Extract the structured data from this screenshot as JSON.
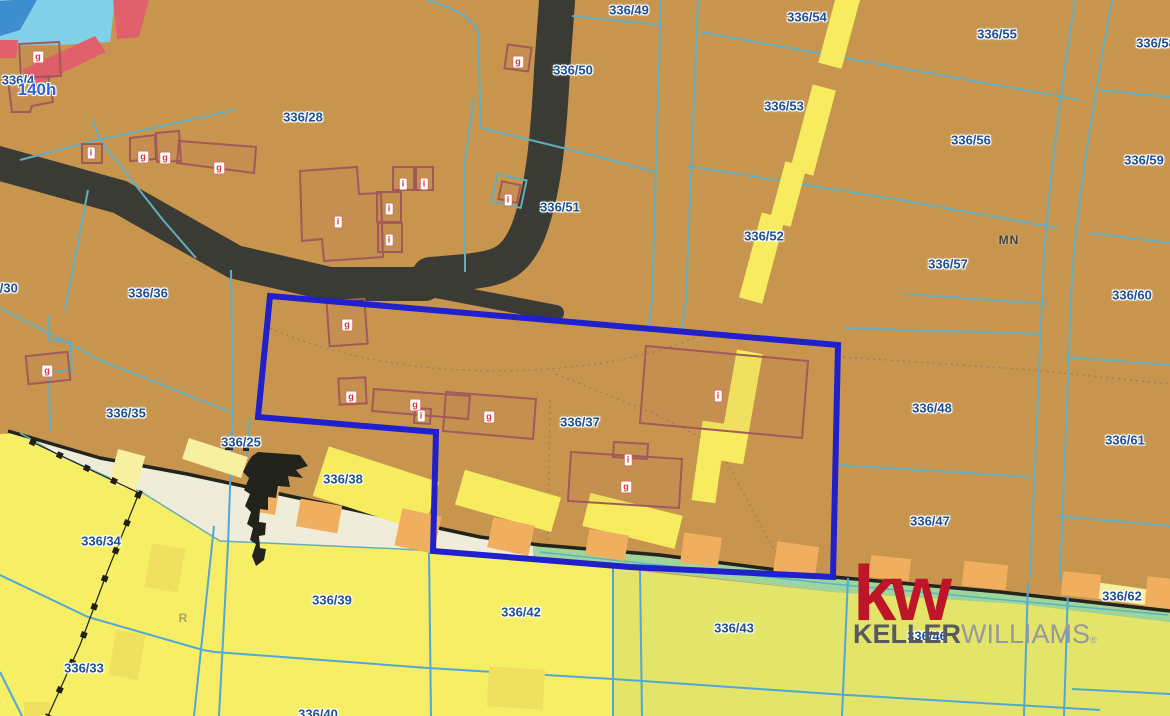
{
  "map": {
    "labels": [
      {
        "text": "336/4",
        "x": 18,
        "y": 80,
        "kind": "parcel"
      },
      {
        "text": "140h",
        "x": 37,
        "y": 90,
        "kind": "hectare"
      },
      {
        "text": "336/28",
        "x": 303,
        "y": 117,
        "kind": "parcel"
      },
      {
        "text": "336/49",
        "x": 629,
        "y": 10,
        "kind": "parcel"
      },
      {
        "text": "336/50",
        "x": 573,
        "y": 70,
        "kind": "parcel"
      },
      {
        "text": "336/51",
        "x": 560,
        "y": 207,
        "kind": "parcel"
      },
      {
        "text": "336/54",
        "x": 807,
        "y": 17,
        "kind": "parcel"
      },
      {
        "text": "336/55",
        "x": 997,
        "y": 34,
        "kind": "parcel"
      },
      {
        "text": "336/53",
        "x": 784,
        "y": 106,
        "kind": "parcel"
      },
      {
        "text": "336/56",
        "x": 971,
        "y": 140,
        "kind": "parcel"
      },
      {
        "text": "336/58",
        "x": 1156,
        "y": 43,
        "kind": "parcel"
      },
      {
        "text": "336/59",
        "x": 1144,
        "y": 160,
        "kind": "parcel"
      },
      {
        "text": "MN",
        "x": 1009,
        "y": 240,
        "kind": "landuse"
      },
      {
        "text": "336/57",
        "x": 948,
        "y": 264,
        "kind": "parcel"
      },
      {
        "text": "336/52",
        "x": 764,
        "y": 236,
        "kind": "parcel"
      },
      {
        "text": "336/60",
        "x": 1132,
        "y": 295,
        "kind": "parcel"
      },
      {
        "text": "336/30",
        "x": -2,
        "y": 288,
        "kind": "parcel"
      },
      {
        "text": "336/36",
        "x": 148,
        "y": 293,
        "kind": "parcel"
      },
      {
        "text": "336/35",
        "x": 126,
        "y": 413,
        "kind": "parcel"
      },
      {
        "text": "336/25",
        "x": 241,
        "y": 442,
        "kind": "parcel"
      },
      {
        "text": "336/38",
        "x": 343,
        "y": 479,
        "kind": "parcel"
      },
      {
        "text": "336/37",
        "x": 580,
        "y": 422,
        "kind": "parcel"
      },
      {
        "text": "336/48",
        "x": 932,
        "y": 408,
        "kind": "parcel"
      },
      {
        "text": "336/61",
        "x": 1125,
        "y": 440,
        "kind": "parcel"
      },
      {
        "text": "336/47",
        "x": 930,
        "y": 521,
        "kind": "parcel"
      },
      {
        "text": "336/34",
        "x": 101,
        "y": 541,
        "kind": "parcel"
      },
      {
        "text": "336/33",
        "x": 84,
        "y": 668,
        "kind": "parcel"
      },
      {
        "text": "336/39",
        "x": 332,
        "y": 600,
        "kind": "parcel"
      },
      {
        "text": "R",
        "x": 183,
        "y": 618,
        "kind": "landuse-r"
      },
      {
        "text": "336/42",
        "x": 521,
        "y": 612,
        "kind": "parcel"
      },
      {
        "text": "336/43",
        "x": 734,
        "y": 628,
        "kind": "parcel"
      },
      {
        "text": "336/46",
        "x": 927,
        "y": 636,
        "kind": "parcel"
      },
      {
        "text": "336/62",
        "x": 1122,
        "y": 596,
        "kind": "parcel"
      },
      {
        "text": "336/40",
        "x": 318,
        "y": 714,
        "kind": "parcel"
      }
    ],
    "building_marks": [
      {
        "letter": "g",
        "x": 38,
        "y": 57
      },
      {
        "letter": "i",
        "x": 91,
        "y": 153
      },
      {
        "letter": "g",
        "x": 143,
        "y": 157
      },
      {
        "letter": "g",
        "x": 165,
        "y": 158
      },
      {
        "letter": "g",
        "x": 219,
        "y": 168
      },
      {
        "letter": "g",
        "x": 518,
        "y": 62
      },
      {
        "letter": "i",
        "x": 508,
        "y": 200
      },
      {
        "letter": "i",
        "x": 338,
        "y": 222
      },
      {
        "letter": "i",
        "x": 403,
        "y": 184
      },
      {
        "letter": "i",
        "x": 424,
        "y": 184
      },
      {
        "letter": "i",
        "x": 389,
        "y": 209
      },
      {
        "letter": "i",
        "x": 389,
        "y": 240
      },
      {
        "letter": "g",
        "x": 47,
        "y": 371
      },
      {
        "letter": "g",
        "x": 347,
        "y": 325
      },
      {
        "letter": "g",
        "x": 351,
        "y": 397
      },
      {
        "letter": "g",
        "x": 415,
        "y": 405
      },
      {
        "letter": "i",
        "x": 421,
        "y": 416
      },
      {
        "letter": "g",
        "x": 489,
        "y": 417
      },
      {
        "letter": "i",
        "x": 628,
        "y": 460
      },
      {
        "letter": "g",
        "x": 626,
        "y": 487
      },
      {
        "letter": "i",
        "x": 718,
        "y": 396
      }
    ]
  },
  "logo": {
    "mark": "kw",
    "name_bold": "KELLER",
    "name_light": "WILLIAMS",
    "registered": "®"
  },
  "colors": {
    "tan": "#C8954F",
    "yellow": "#F6EF66",
    "yellowGreen": "#E2E56A",
    "cream": "#EFEDDA",
    "green": "#9FD49B",
    "orange": "#F0AE5F",
    "roadDark": "#3B3B35",
    "teal": "#66ADBB",
    "blueLine": "#53A7D6",
    "parcelLabel": "#1D4F93",
    "hectare": "#2F64D8",
    "buildingOutline": "#A2595A",
    "chipRed": "#E03434",
    "polygonBlue": "#2020CC",
    "water": "#82CFE8",
    "navy": "#3E8ECF",
    "red": "#E2606B",
    "dashYellow": "#F7EC60",
    "dashPale": "#F7F0A0",
    "kwRed": "#BE1528",
    "kellerGray": "#595A60",
    "williamsGray": "#97979F"
  }
}
